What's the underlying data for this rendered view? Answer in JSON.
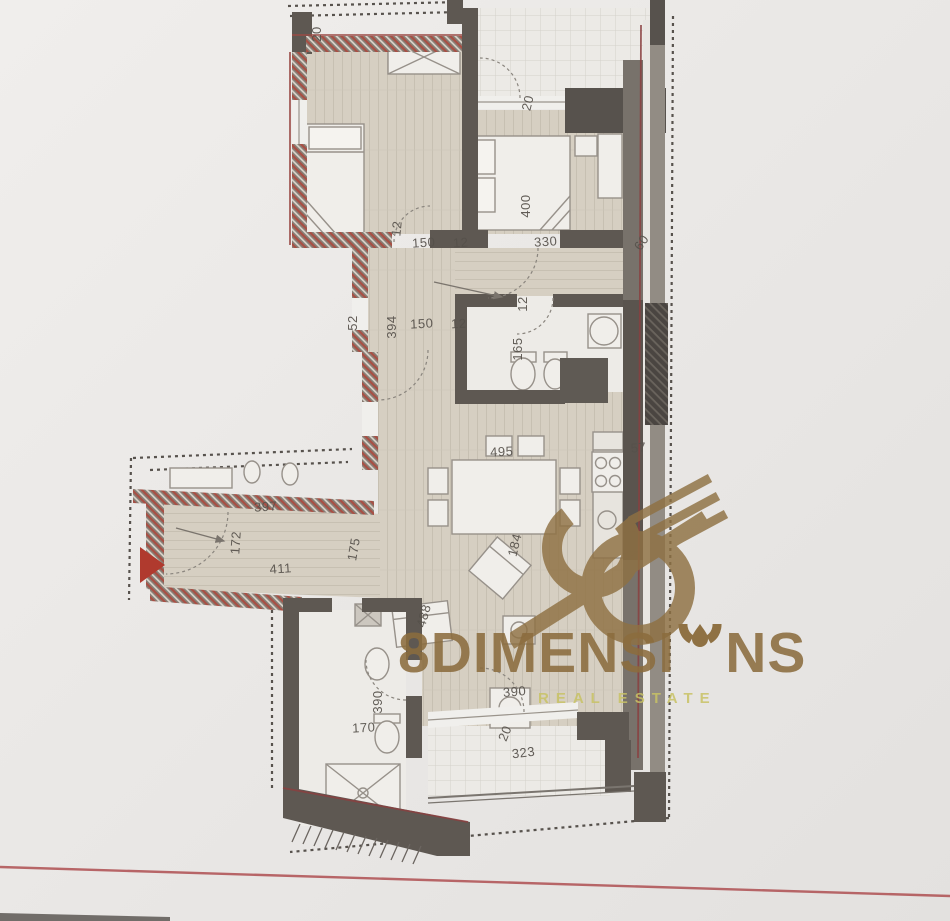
{
  "watermark": {
    "brand_part1": "8DIMENSI",
    "brand_part2": "NS",
    "subtitle": "REAL ESTATE",
    "brand_color": "#8a6c3e",
    "subtitle_color": "#c8c264"
  },
  "floorplan": {
    "colors": {
      "paper": "#eae8e6",
      "wall_dark": "#5e5852",
      "wall_mid": "#78726b",
      "floor_wood": "#d6cfc2",
      "bath_floor": "#edebe7",
      "hatch_red": "#a84f44",
      "entrance_arrow_red": "#b03a2e",
      "reference_line_red": "#b2585a",
      "dimension_text": "#56514b"
    },
    "dimension_labels": [
      {
        "text": "20",
        "x": 321,
        "y": 34,
        "angle": -90,
        "size": 12
      },
      {
        "text": "150",
        "x": 424,
        "y": 247,
        "angle": -4
      },
      {
        "text": "12",
        "x": 401,
        "y": 229,
        "angle": -84,
        "size": 11
      },
      {
        "text": "12",
        "x": 461,
        "y": 247,
        "angle": -4,
        "size": 11
      },
      {
        "text": "330",
        "x": 546,
        "y": 246,
        "angle": -4
      },
      {
        "text": "20",
        "x": 532,
        "y": 104,
        "angle": -76,
        "size": 12
      },
      {
        "text": "400",
        "x": 530,
        "y": 206,
        "angle": -90
      },
      {
        "text": "60",
        "x": 645,
        "y": 245,
        "angle": -55,
        "size": 12
      },
      {
        "text": "394",
        "x": 396,
        "y": 327,
        "angle": -90,
        "size": 12
      },
      {
        "text": "150",
        "x": 422,
        "y": 328,
        "angle": -3
      },
      {
        "text": "12",
        "x": 459,
        "y": 328,
        "angle": -3,
        "size": 11
      },
      {
        "text": "12",
        "x": 527,
        "y": 304,
        "angle": -90,
        "size": 11
      },
      {
        "text": "165",
        "x": 522,
        "y": 349,
        "angle": -90,
        "size": 12
      },
      {
        "text": "52",
        "x": 357,
        "y": 323,
        "angle": -90,
        "size": 10
      },
      {
        "text": "495",
        "x": 502,
        "y": 456,
        "angle": -3
      },
      {
        "text": "57",
        "x": 639,
        "y": 452,
        "angle": -6,
        "size": 12
      },
      {
        "text": "397",
        "x": 266,
        "y": 511,
        "angle": -4
      },
      {
        "text": "172",
        "x": 240,
        "y": 543,
        "angle": -86,
        "size": 12
      },
      {
        "text": "175",
        "x": 358,
        "y": 550,
        "angle": -80,
        "size": 12
      },
      {
        "text": "411",
        "x": 281,
        "y": 573,
        "angle": -4
      },
      {
        "text": "184",
        "x": 519,
        "y": 546,
        "angle": -76,
        "size": 12
      },
      {
        "text": "488",
        "x": 428,
        "y": 617,
        "angle": -74,
        "size": 12
      },
      {
        "text": "390",
        "x": 382,
        "y": 702,
        "angle": -90,
        "size": 12
      },
      {
        "text": "170",
        "x": 364,
        "y": 732,
        "angle": -3,
        "size": 12
      },
      {
        "text": "390",
        "x": 515,
        "y": 696,
        "angle": -5
      },
      {
        "text": "20",
        "x": 509,
        "y": 735,
        "angle": -68,
        "size": 11
      },
      {
        "text": "323",
        "x": 524,
        "y": 757,
        "angle": -7
      }
    ]
  }
}
